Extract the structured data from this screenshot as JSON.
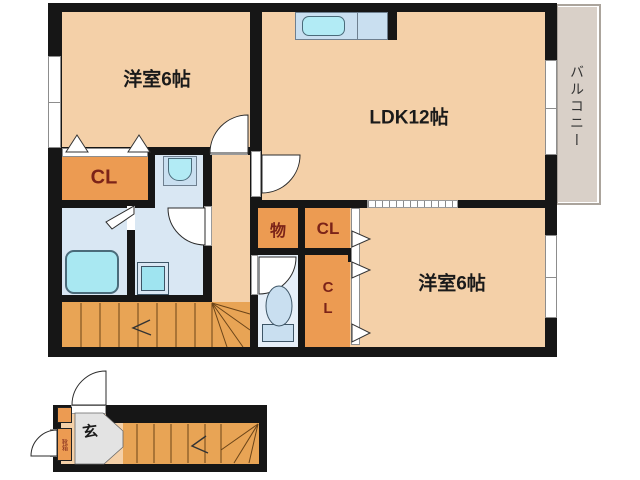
{
  "labels": {
    "bedroom1": "洋室6帖",
    "ldk": "LDK12帖",
    "bedroom2": "洋室6帖",
    "balcony": "バルコニー",
    "closet1": "CL",
    "storage": "物",
    "closet2": "CL",
    "closet3": "CL",
    "entrance": "玄",
    "shoe_cabinet": "靴箱"
  },
  "colors": {
    "room_floor": "#F4D0A8",
    "closet_fill": "#EC9B52",
    "closet_text": "#7B2318",
    "wet_area": "#D9E7F3",
    "fixture_blue": "#B2EBF5",
    "stairs": "#E8A455",
    "balcony": "#D9D0C8",
    "entrance_floor": "#E3E3E3",
    "wall": "#161616"
  }
}
